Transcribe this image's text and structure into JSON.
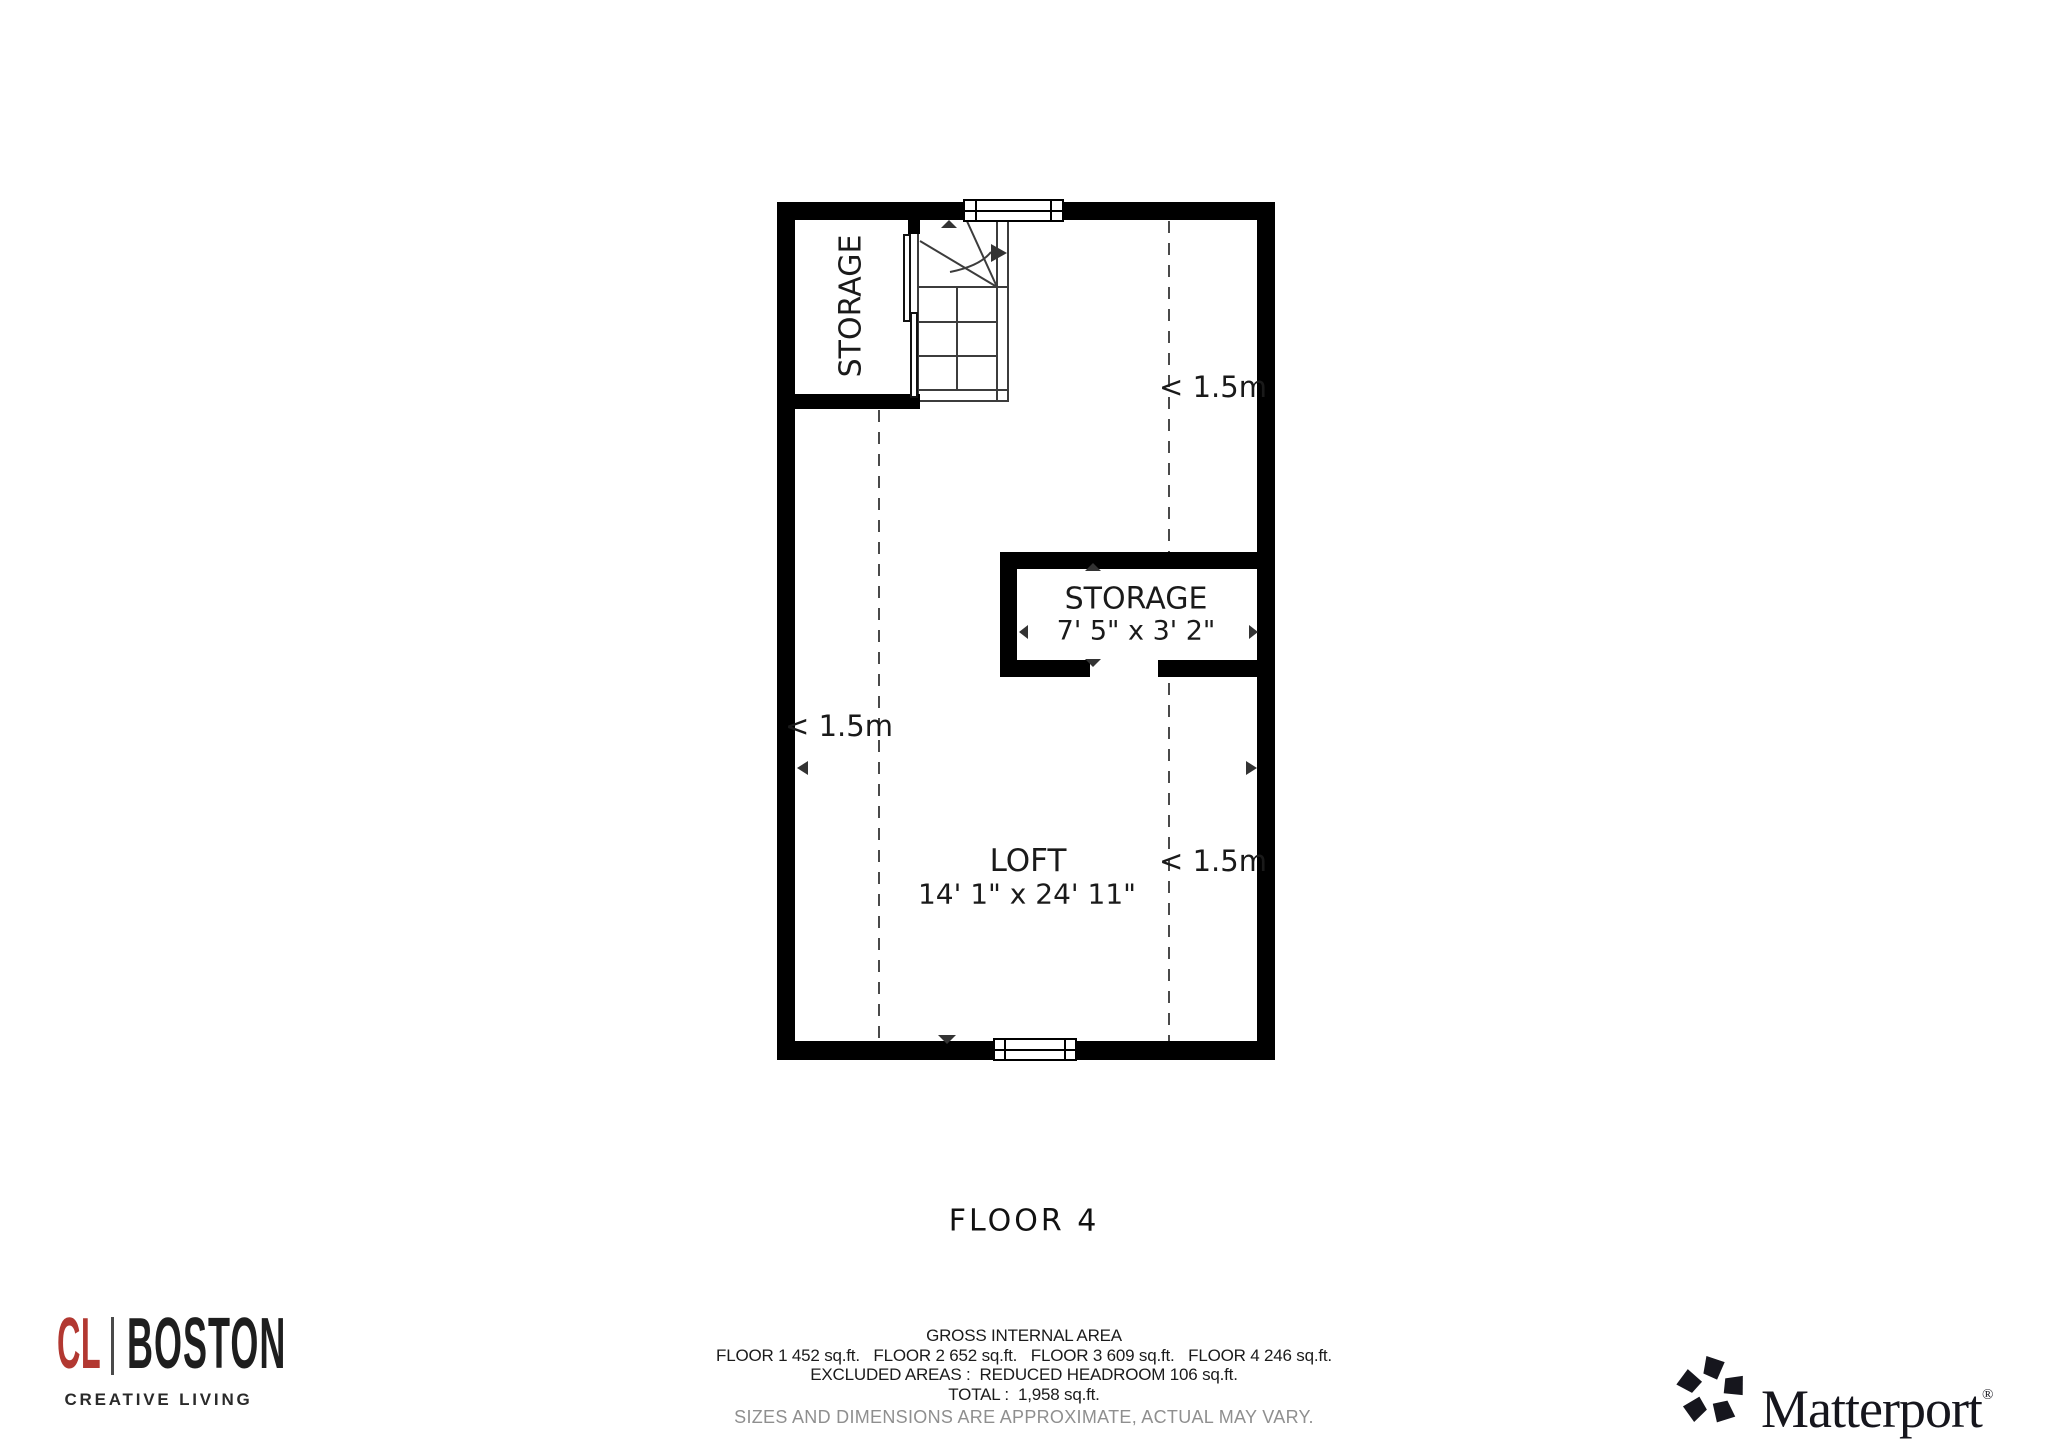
{
  "plan": {
    "rooms": {
      "storage_top": {
        "label": "STORAGE"
      },
      "storage_mid": {
        "label": "STORAGE",
        "dims": "7' 5\" x 3' 2\""
      },
      "loft": {
        "label": "LOFT",
        "dims": "14' 1\" x 24' 11\""
      }
    },
    "headroom_label": "< 1.5m"
  },
  "title": "FLOOR 4",
  "footer": {
    "line1": "GROSS INTERNAL AREA",
    "line2": "FLOOR 1 452 sq.ft.   FLOOR 2 652 sq.ft.   FLOOR 3 609 sq.ft.   FLOOR 4 246 sq.ft.",
    "line3": "EXCLUDED AREAS :  REDUCED HEADROOM 106 sq.ft.",
    "line4": "TOTAL :  1,958 sq.ft.",
    "disclaimer": "SIZES AND DIMENSIONS ARE APPROXIMATE, ACTUAL MAY VARY."
  },
  "branding": {
    "cl_boston": {
      "monogram": "CL",
      "name": "BOSTON",
      "tagline": "CREATIVE LIVING",
      "accent_color": "#b23831"
    },
    "matterport": {
      "name": "Matterport",
      "registered": "®"
    }
  },
  "colors": {
    "wall": "#000000",
    "stair_line": "#3c3c3c",
    "dashed_line": "#4a4a4a",
    "text": "#1a1a1a",
    "disclaimer_gray": "#8f8f8f"
  }
}
